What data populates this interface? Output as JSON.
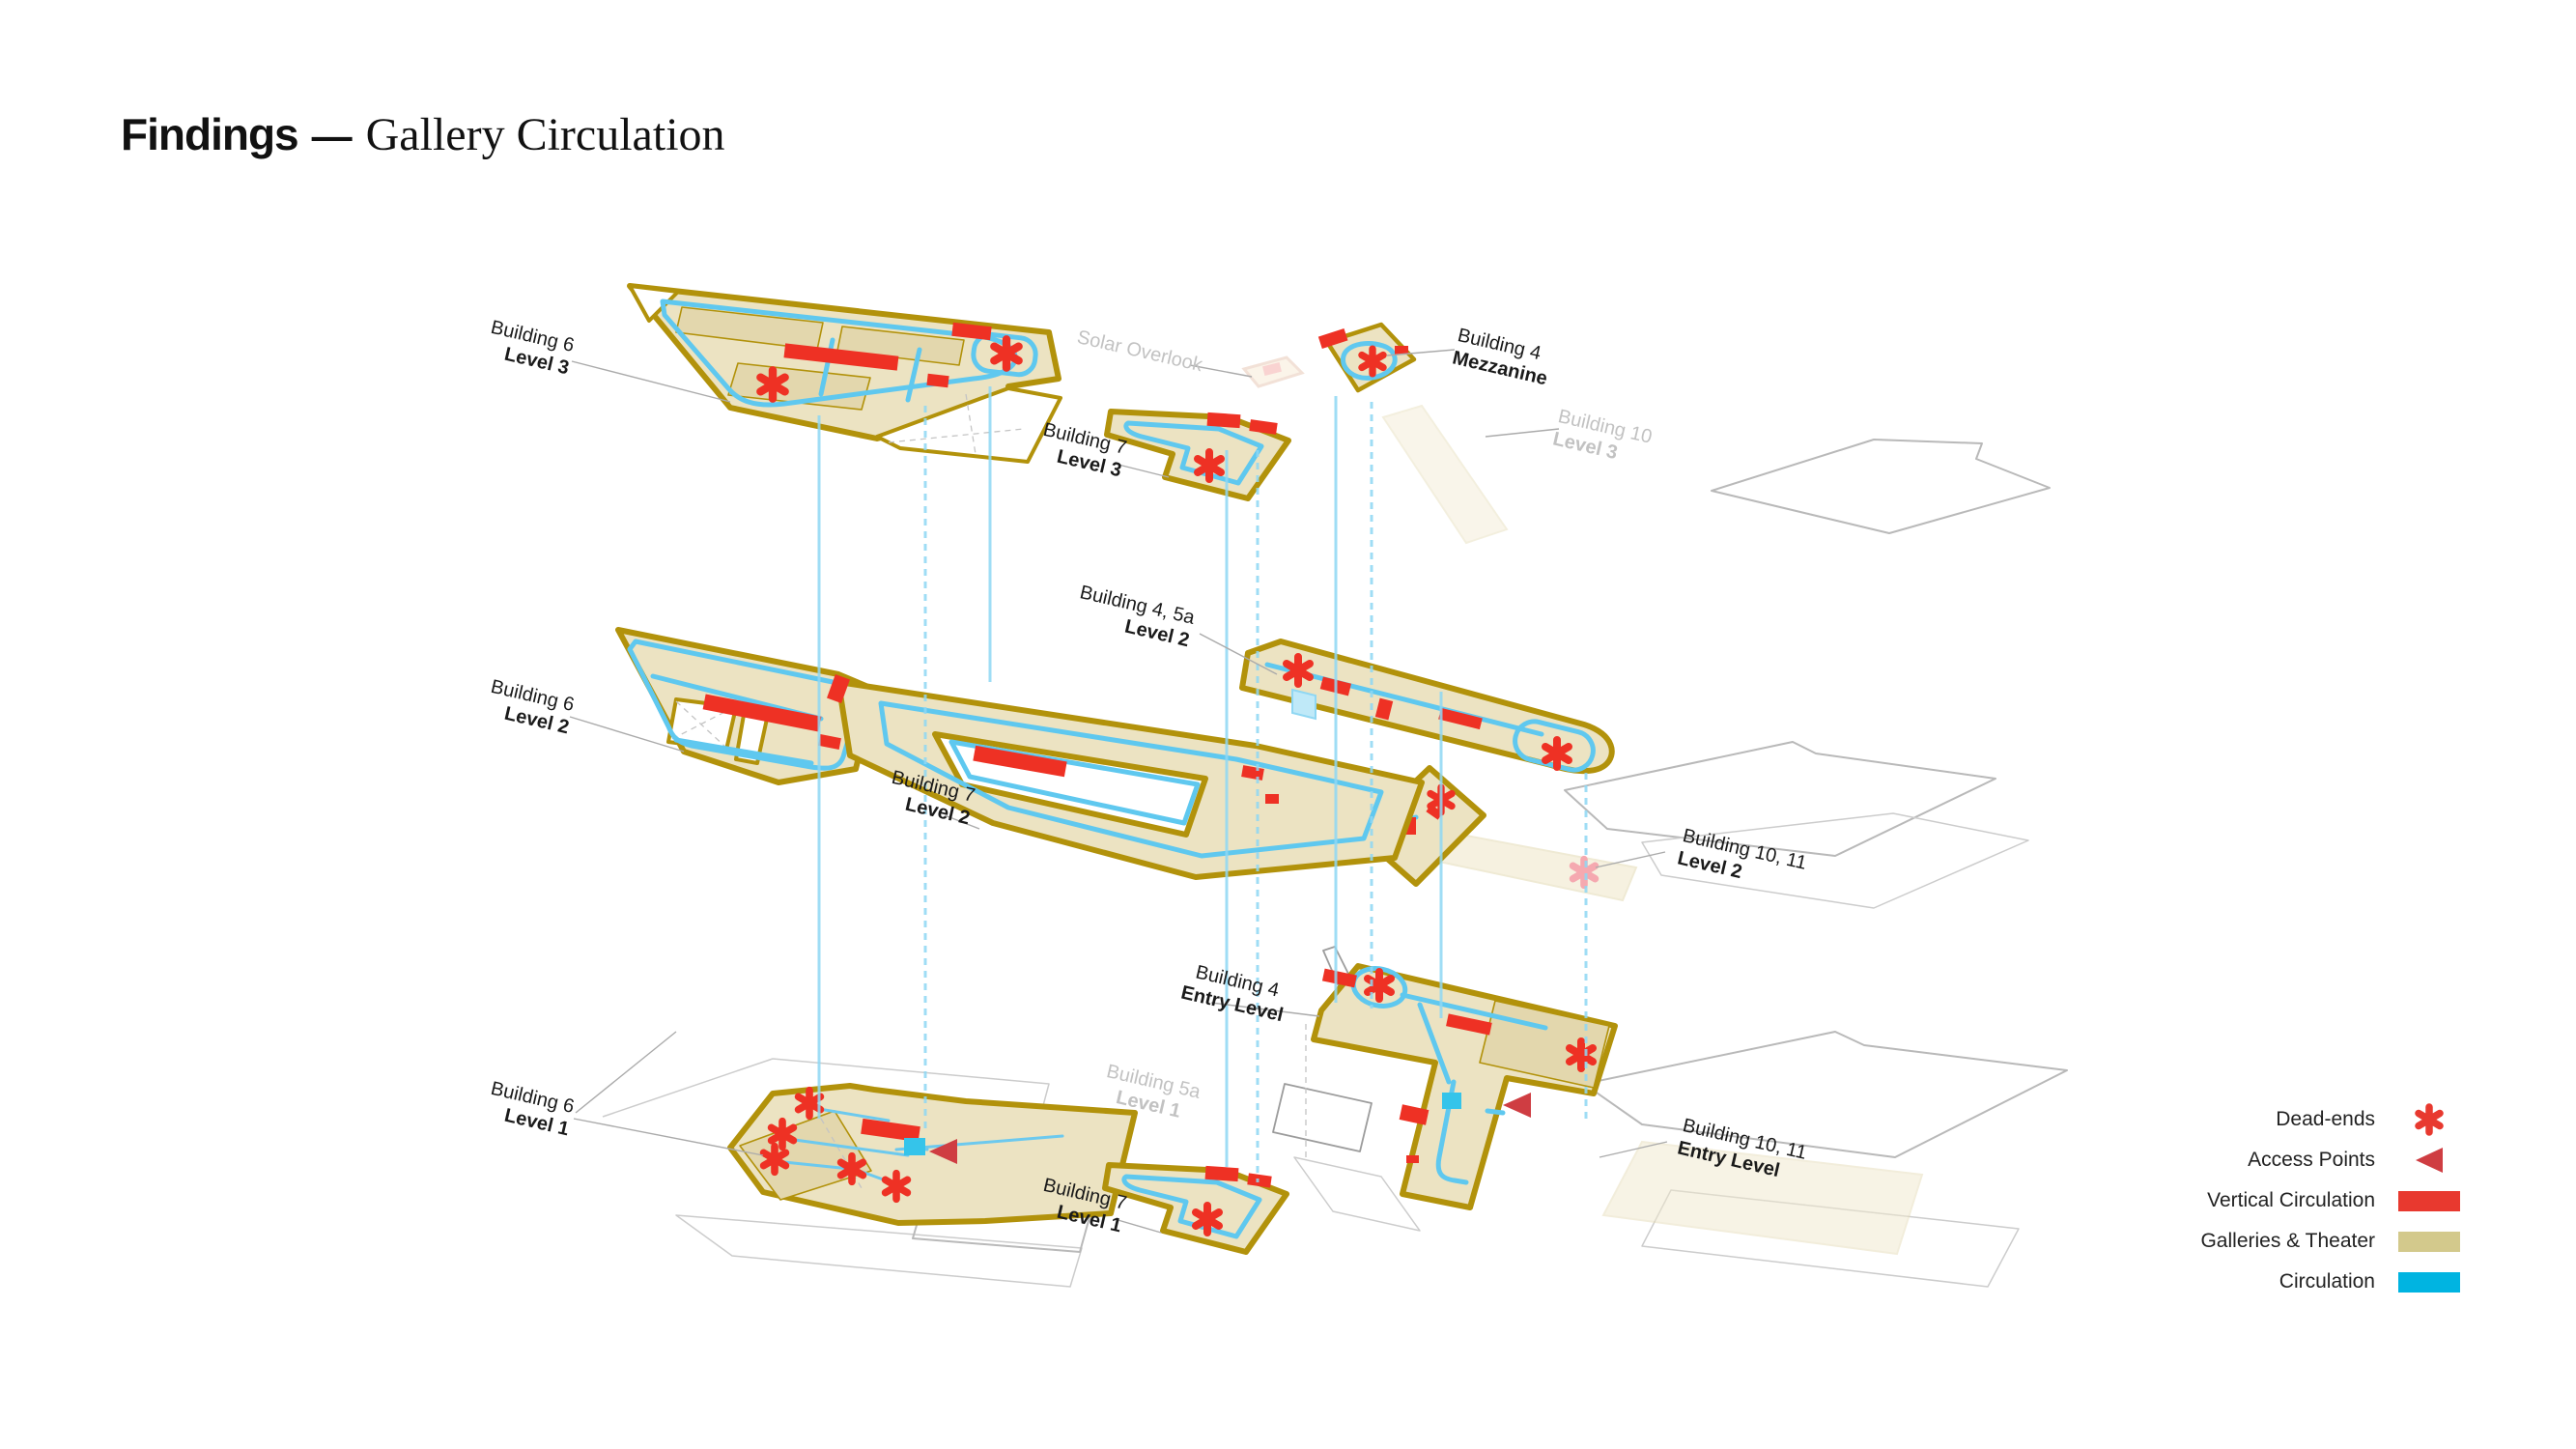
{
  "title": {
    "bold": "Findings",
    "separator": "—",
    "serif": "Gallery Circulation"
  },
  "legend": {
    "items": [
      {
        "label": "Dead-ends",
        "marker": "asterisk-icon",
        "color": "#e8392f"
      },
      {
        "label": "Access Points",
        "marker": "triangle-icon",
        "color": "#cf3d42"
      },
      {
        "label": "Vertical Circulation",
        "marker": "swatch",
        "color": "#e8392f"
      },
      {
        "label": "Galleries & Theater",
        "marker": "swatch",
        "color": "#d3c98c"
      },
      {
        "label": "Circulation",
        "marker": "swatch",
        "color": "#00b4e1"
      }
    ]
  },
  "colors": {
    "plate_fill": "#ece3c2",
    "plate_border": "#b2920b",
    "circulation_path": "#5fc8ef",
    "vertical_circulation": "#ee3124",
    "access_point": "#cf3d42",
    "faded_dead_end": "#f5a9b0",
    "ghost_outline": "#b9b9b9",
    "muted_label": "#c2c2c2"
  },
  "diagram": {
    "labels": [
      {
        "id": "building-6-level-3",
        "line1": "Building 6",
        "line2": "Level 3",
        "muted": false
      },
      {
        "id": "solar-overlook",
        "line1": "Solar Overlook",
        "line2": "",
        "muted": true
      },
      {
        "id": "building-4-mezzanine",
        "line1": "Building 4",
        "line2": "Mezzanine",
        "muted": false
      },
      {
        "id": "building-10-level-3",
        "line1": "Building 10",
        "line2": "Level 3",
        "muted": true
      },
      {
        "id": "building-7-level-3",
        "line1": "Building 7",
        "line2": "Level 3",
        "muted": false
      },
      {
        "id": "building-4-5a-level-2",
        "line1": "Building 4, 5a",
        "line2": "Level 2",
        "muted": false
      },
      {
        "id": "building-6-level-2",
        "line1": "Building 6",
        "line2": "Level 2",
        "muted": false
      },
      {
        "id": "building-7-level-2",
        "line1": "Building 7",
        "line2": "Level 2",
        "muted": false
      },
      {
        "id": "building-10-11-level-2",
        "line1": "Building 10, 11",
        "line2": "Level 2",
        "muted": false
      },
      {
        "id": "building-4-entry-level",
        "line1": "Building 4",
        "line2": "Entry Level",
        "muted": false
      },
      {
        "id": "building-5a-level-1",
        "line1": "Building 5a",
        "line2": "Level 1",
        "muted": true
      },
      {
        "id": "building-6-level-1",
        "line1": "Building 6",
        "line2": "Level 1",
        "muted": false
      },
      {
        "id": "building-7-level-1",
        "line1": "Building 7",
        "line2": "Level 1",
        "muted": false
      },
      {
        "id": "building-10-11-entry-level",
        "line1": "Building 10, 11",
        "line2": "Entry Level",
        "muted": false
      }
    ]
  }
}
